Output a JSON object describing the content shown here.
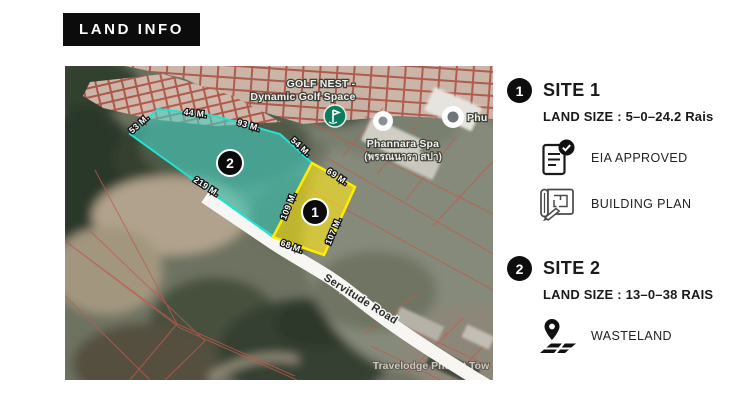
{
  "header": {
    "title": "LAND INFO"
  },
  "map": {
    "labels": {
      "golf_line1": "GOLF NEST -",
      "golf_line2": "Dynamic Golf Space",
      "spa_line1": "Phannara Spa",
      "spa_line2": "(พรรณนารา สปา)",
      "phu": "Phu",
      "road": "Servitude Road",
      "travelodge": "Travelodge Phuket Tow"
    },
    "badges": {
      "site1": "1",
      "site2": "2"
    },
    "measurements": {
      "site2": [
        "53 M.",
        "44 M.",
        "93 M.",
        "54 M.",
        "219 M."
      ],
      "site1": [
        "69 M.",
        "109 M.",
        "107 M.",
        "68 M."
      ]
    },
    "plot_colors": {
      "site1_fill": "#ffe81a",
      "site1_stroke": "#ffec00",
      "site2_fill": "#45d0c1",
      "site2_stroke": "#1fe3d3"
    }
  },
  "sites": [
    {
      "badge": "1",
      "name": "SITE 1",
      "land_size": "LAND SIZE : 5–0–24.2 Rais",
      "features": [
        {
          "icon": "eia-approved-icon",
          "label": "EIA APPROVED"
        },
        {
          "icon": "building-plan-icon",
          "label": "BUILDING PLAN"
        }
      ]
    },
    {
      "badge": "2",
      "name": "SITE 2",
      "land_size": "LAND SIZE : 13–0–38 RAIS",
      "features": [
        {
          "icon": "wasteland-icon",
          "label": "WASTELAND"
        }
      ]
    }
  ]
}
